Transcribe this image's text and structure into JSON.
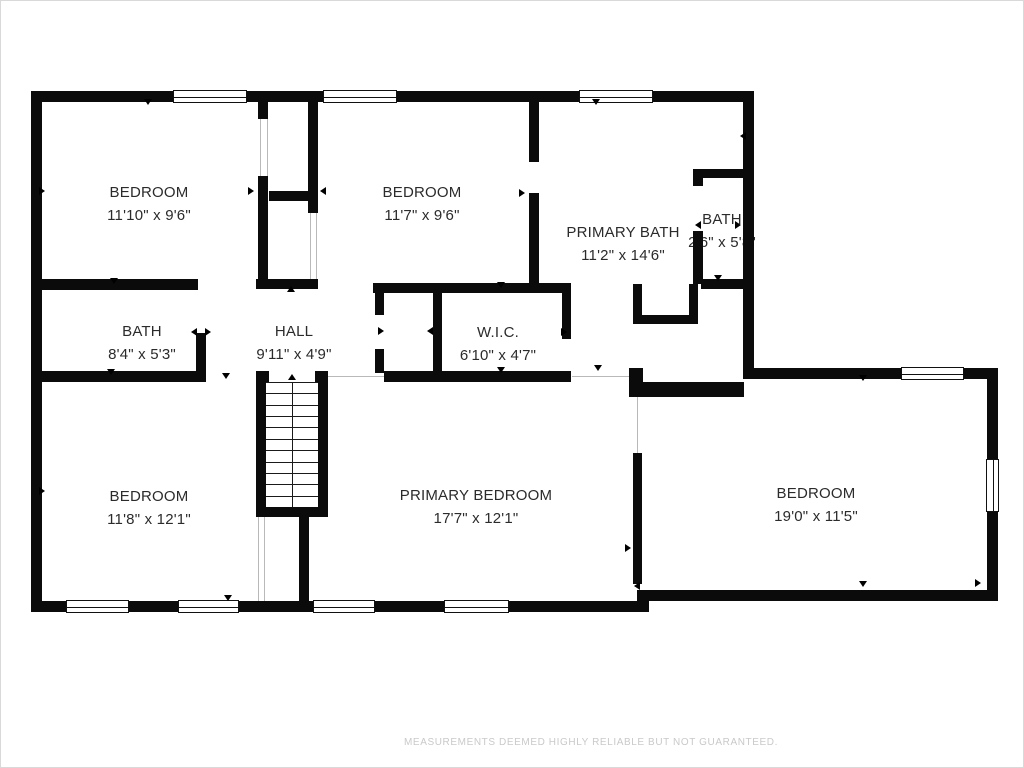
{
  "footer": {
    "text": "MEASUREMENTS DEEMED HIGHLY RELIABLE BUT NOT GUARANTEED."
  },
  "colors": {
    "wall": "#0b0b0b",
    "background": "#ffffff",
    "label_text": "#2b2b2b",
    "footer_text": "#c9c9c9",
    "opening_line": "#b9b9b9"
  },
  "rooms": [
    {
      "id": "bedroom-top-left",
      "name": "BEDROOM",
      "dims": "11'10\" x 9'6\""
    },
    {
      "id": "bedroom-top-middle",
      "name": "BEDROOM",
      "dims": "11'7\" x 9'6\""
    },
    {
      "id": "primary-bath",
      "name": "PRIMARY BATH",
      "dims": "11'2\" x 14'6\""
    },
    {
      "id": "bath-small",
      "name": "BATH",
      "dims": "2'6\" x 5'8\""
    },
    {
      "id": "bath",
      "name": "BATH",
      "dims": "8'4\" x 5'3\""
    },
    {
      "id": "hall",
      "name": "HALL",
      "dims": "9'11\" x 4'9\""
    },
    {
      "id": "walk-in-closet",
      "name": "W.I.C.",
      "dims": "6'10\" x 4'7\""
    },
    {
      "id": "bedroom-bottom-left",
      "name": "BEDROOM",
      "dims": "11'8\" x 12'1\""
    },
    {
      "id": "primary-bedroom",
      "name": "PRIMARY BEDROOM",
      "dims": "17'7\" x 12'1\""
    },
    {
      "id": "bedroom-right",
      "name": "BEDROOM",
      "dims": "19'0\" x 11'5\""
    }
  ],
  "plan": {
    "walls": [
      [
        30,
        90,
        723,
        11
      ],
      [
        30,
        90,
        11,
        521
      ],
      [
        30,
        600,
        618,
        11
      ],
      [
        742,
        90,
        11,
        288
      ],
      [
        742,
        367,
        255,
        11
      ],
      [
        986,
        367,
        11,
        233
      ],
      [
        636,
        589,
        361,
        11
      ],
      [
        257,
        101,
        10,
        17
      ],
      [
        257,
        175,
        10,
        103
      ],
      [
        307,
        101,
        10,
        111
      ],
      [
        268,
        190,
        39,
        10
      ],
      [
        255,
        278,
        62,
        10
      ],
      [
        528,
        101,
        10,
        60
      ],
      [
        528,
        192,
        10,
        95
      ],
      [
        30,
        278,
        167,
        11
      ],
      [
        195,
        332,
        10,
        42
      ],
      [
        30,
        370,
        175,
        11
      ],
      [
        255,
        370,
        13,
        11
      ],
      [
        314,
        370,
        13,
        11
      ],
      [
        383,
        370,
        187,
        11
      ],
      [
        628,
        367,
        14,
        29
      ],
      [
        642,
        381,
        101,
        15
      ],
      [
        372,
        282,
        198,
        10
      ],
      [
        374,
        292,
        9,
        22
      ],
      [
        374,
        348,
        9,
        24
      ],
      [
        432,
        292,
        9,
        80
      ],
      [
        561,
        292,
        9,
        46
      ],
      [
        692,
        168,
        53,
        9
      ],
      [
        692,
        168,
        10,
        17
      ],
      [
        692,
        230,
        10,
        53
      ],
      [
        700,
        278,
        45,
        10
      ],
      [
        632,
        283,
        9,
        40
      ],
      [
        688,
        283,
        9,
        40
      ],
      [
        632,
        314,
        65,
        9
      ],
      [
        255,
        372,
        10,
        144
      ],
      [
        317,
        372,
        10,
        144
      ],
      [
        255,
        506,
        72,
        10
      ],
      [
        298,
        516,
        10,
        95
      ],
      [
        632,
        452,
        9,
        131
      ]
    ],
    "windows": [
      [
        172,
        89,
        74,
        13,
        "h"
      ],
      [
        322,
        89,
        74,
        13,
        "h"
      ],
      [
        578,
        89,
        74,
        13,
        "h"
      ],
      [
        65,
        599,
        63,
        13,
        "h"
      ],
      [
        177,
        599,
        61,
        13,
        "h"
      ],
      [
        312,
        599,
        62,
        13,
        "h"
      ],
      [
        443,
        599,
        65,
        13,
        "h"
      ],
      [
        900,
        366,
        63,
        13,
        "h"
      ],
      [
        985,
        458,
        13,
        53,
        "v"
      ]
    ],
    "thin_lines": [
      [
        309,
        212,
        1,
        66
      ],
      [
        315,
        212,
        1,
        66
      ],
      [
        259,
        118,
        1,
        57
      ],
      [
        266,
        118,
        1,
        57
      ],
      [
        257,
        516,
        1,
        84
      ],
      [
        263,
        516,
        1,
        84
      ],
      [
        327,
        375,
        57,
        1
      ],
      [
        571,
        375,
        57,
        1
      ],
      [
        636,
        396,
        1,
        56
      ]
    ],
    "door_arrows": [
      [
        147,
        104,
        "down"
      ],
      [
        44,
        190,
        "right"
      ],
      [
        44,
        490,
        "right"
      ],
      [
        595,
        104,
        "down"
      ],
      [
        739,
        135,
        "left"
      ],
      [
        253,
        190,
        "right"
      ],
      [
        319,
        190,
        "left"
      ],
      [
        290,
        291,
        "up"
      ],
      [
        113,
        283,
        "down"
      ],
      [
        110,
        374,
        "down"
      ],
      [
        225,
        378,
        "down"
      ],
      [
        190,
        331,
        "left"
      ],
      [
        210,
        331,
        "right"
      ],
      [
        383,
        330,
        "right"
      ],
      [
        426,
        330,
        "left"
      ],
      [
        566,
        331,
        "right"
      ],
      [
        500,
        287,
        "down"
      ],
      [
        500,
        372,
        "down"
      ],
      [
        597,
        370,
        "down"
      ],
      [
        524,
        192,
        "right"
      ],
      [
        694,
        224,
        "left"
      ],
      [
        740,
        224,
        "right"
      ],
      [
        717,
        280,
        "down"
      ],
      [
        630,
        547,
        "right"
      ],
      [
        633,
        585,
        "left"
      ],
      [
        227,
        600,
        "down"
      ],
      [
        862,
        380,
        "down"
      ],
      [
        862,
        586,
        "down"
      ],
      [
        980,
        582,
        "right"
      ]
    ],
    "stairs": {
      "x": 265,
      "y": 381,
      "w": 52,
      "h": 125,
      "steps": 11,
      "center_x": 291,
      "arrow_y": 379
    }
  }
}
